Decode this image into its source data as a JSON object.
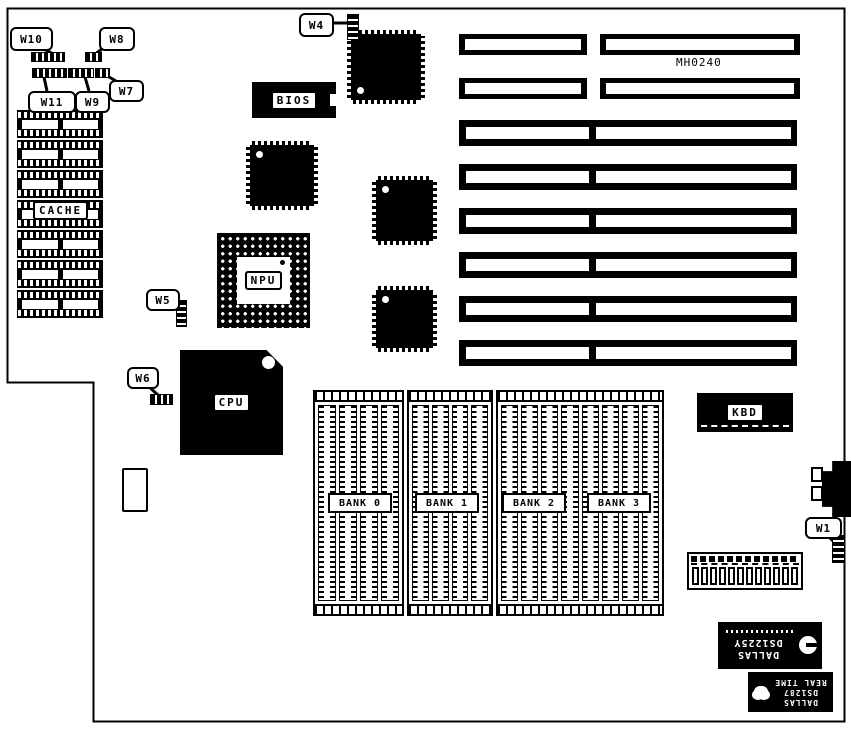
{
  "board": {
    "silkscreen": "MH0240"
  },
  "chips": {
    "bios": {
      "label": "BIOS"
    },
    "npu": {
      "label": "NPU"
    },
    "cpu": {
      "label": "CPU"
    },
    "kbd": {
      "label": "KBD"
    },
    "cache": {
      "label": "CACHE",
      "rows": 7
    }
  },
  "memory": {
    "bank_labels": [
      "BANK 0",
      "BANK 1",
      "BANK 2",
      "BANK 3"
    ],
    "boxes": [
      {
        "columns": 4
      },
      {
        "columns": 4
      },
      {
        "columns": 8
      }
    ]
  },
  "expansion_slots": {
    "rows_8bit": 2,
    "rows_16bit": 6
  },
  "jumpers": {
    "w1": {
      "label": "W1"
    },
    "w4": {
      "label": "W4"
    },
    "w5": {
      "label": "W5"
    },
    "w6": {
      "label": "W6"
    },
    "w7": {
      "label": "W7"
    },
    "w8": {
      "label": "W8"
    },
    "w9": {
      "label": "W9"
    },
    "w10": {
      "label": "W10"
    },
    "w11": {
      "label": "W11"
    }
  },
  "rtc_chips": {
    "ds1225y": {
      "brand": "DALLAS",
      "part": "DS1225Y"
    },
    "ds1287": {
      "brand": "DALLAS",
      "part": "DS1287",
      "line3": "REAL TIME"
    }
  },
  "power_connector": {
    "pins": 12
  }
}
